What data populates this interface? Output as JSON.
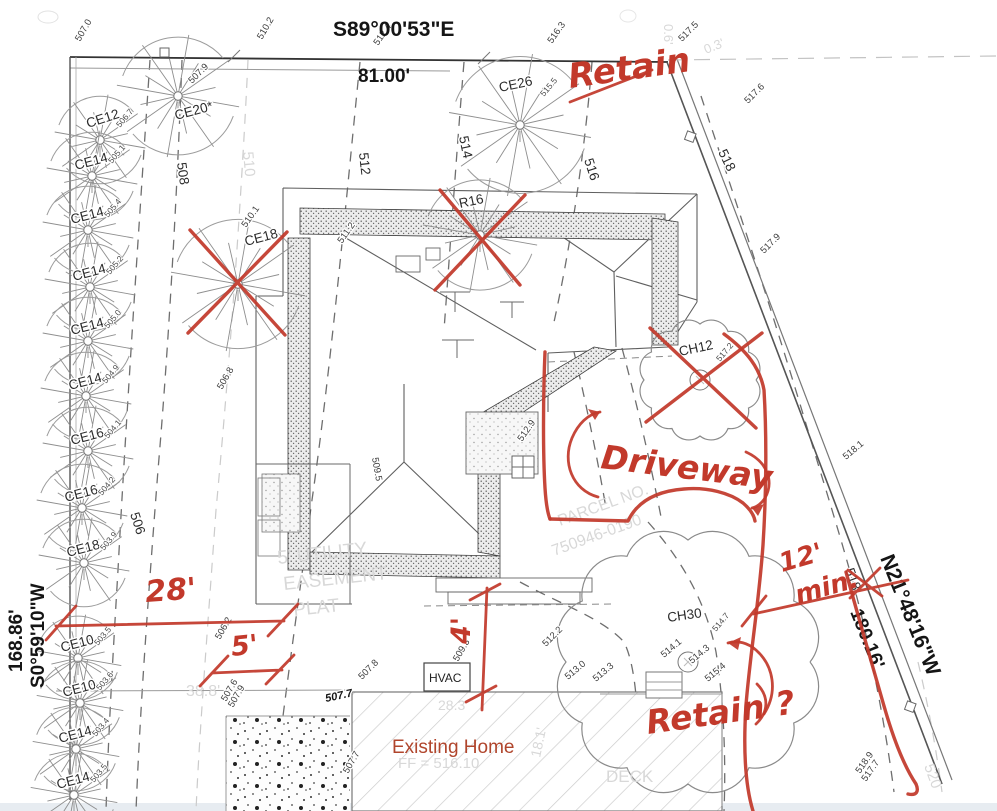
{
  "boundary": {
    "top_bearing": "S89°00'53\"E",
    "top_distance": "81.00'",
    "left_distance": "168.86'",
    "left_bearing": "S0°59'10\"W",
    "right_bearing": "N21°48'16\"W",
    "right_distance": "180.16'"
  },
  "structures": {
    "hvac": "HVAC",
    "existing_home": "Existing Home"
  },
  "red_annotations": {
    "retain_top": "Retain",
    "driveway": "Driveway",
    "dim28": "28'",
    "dim5": "5'",
    "dim4": "4'",
    "dim12": "12'",
    "dim12b": "min.",
    "retain_q": "Retain ?"
  },
  "contour_labels": [
    {
      "t": "506",
      "x": 130,
      "y": 514,
      "r": 72
    },
    {
      "t": "508",
      "x": 177,
      "y": 163,
      "r": 82
    },
    {
      "t": "512",
      "x": 359,
      "y": 153,
      "r": 84
    },
    {
      "t": "514",
      "x": 459,
      "y": 137,
      "r": 78
    },
    {
      "t": "516",
      "x": 584,
      "y": 160,
      "r": 72
    },
    {
      "t": "518",
      "x": 718,
      "y": 152,
      "r": 64
    },
    {
      "t": "518",
      "x": 845,
      "y": 570,
      "r": 70
    }
  ],
  "spots": [
    {
      "t": "507.0",
      "x": 80,
      "y": 42,
      "r": -60
    },
    {
      "t": "510.2",
      "x": 262,
      "y": 40,
      "r": -60
    },
    {
      "t": "512.4",
      "x": 378,
      "y": 46,
      "r": -55
    },
    {
      "t": "516.3",
      "x": 552,
      "y": 44,
      "r": -55
    },
    {
      "t": "517.5",
      "x": 682,
      "y": 42,
      "r": -45
    },
    {
      "t": "517.6",
      "x": 748,
      "y": 104,
      "r": -45
    },
    {
      "t": "517.9",
      "x": 764,
      "y": 254,
      "r": -45
    },
    {
      "t": "507.9",
      "x": 192,
      "y": 84,
      "r": -45
    },
    {
      "t": "510.1",
      "x": 246,
      "y": 228,
      "r": -55
    },
    {
      "t": "511.2",
      "x": 342,
      "y": 244,
      "r": -55
    },
    {
      "t": "509.5",
      "x": 372,
      "y": 458,
      "r": 80
    },
    {
      "t": "512.9",
      "x": 522,
      "y": 442,
      "r": -55
    },
    {
      "t": "506.8",
      "x": 222,
      "y": 390,
      "r": -60
    },
    {
      "t": "518.1",
      "x": 846,
      "y": 460,
      "r": -40
    },
    {
      "t": "514.1",
      "x": 664,
      "y": 658,
      "r": -40
    },
    {
      "t": "514.3",
      "x": 692,
      "y": 664,
      "r": -40
    },
    {
      "t": "515.4",
      "x": 708,
      "y": 682,
      "r": -40
    },
    {
      "t": "513.0",
      "x": 568,
      "y": 680,
      "r": -40
    },
    {
      "t": "513.3",
      "x": 596,
      "y": 682,
      "r": -40
    },
    {
      "t": "512.2",
      "x": 546,
      "y": 647,
      "r": -45
    },
    {
      "t": "509.3",
      "x": 458,
      "y": 662,
      "r": -60
    },
    {
      "t": "507.8",
      "x": 362,
      "y": 680,
      "r": -45
    },
    {
      "t": "507.7",
      "x": 326,
      "y": 702,
      "r": -12,
      "b": true
    },
    {
      "t": "507.6",
      "x": 226,
      "y": 702,
      "r": -60
    },
    {
      "t": "507.9",
      "x": 233,
      "y": 708,
      "r": -60
    },
    {
      "t": "506.2",
      "x": 220,
      "y": 640,
      "r": -60
    },
    {
      "t": "507.7",
      "x": 348,
      "y": 774,
      "r": -60
    },
    {
      "t": "518.9",
      "x": 860,
      "y": 774,
      "r": -55
    },
    {
      "t": "517.7",
      "x": 866,
      "y": 782,
      "r": -55
    }
  ],
  "faded_labels": [
    {
      "t": "0.6'",
      "x": 664,
      "y": 24,
      "r": 90,
      "s": 13
    },
    {
      "t": "0.3'",
      "x": 706,
      "y": 54,
      "r": -22,
      "s": 13
    },
    {
      "t": "510",
      "x": 243,
      "y": 152,
      "r": 85,
      "s": 15
    },
    {
      "t": "38.8'",
      "x": 186,
      "y": 696,
      "s": 16
    },
    {
      "t": "28.3'",
      "x": 438,
      "y": 710,
      "s": 14
    },
    {
      "t": "18.1'",
      "x": 540,
      "y": 758,
      "r": -78,
      "s": 14
    },
    {
      "t": "5' UTILITY",
      "x": 278,
      "y": 564,
      "r": -6,
      "s": 19
    },
    {
      "t": "EASEMENT",
      "x": 284,
      "y": 590,
      "r": -6,
      "s": 19
    },
    {
      "t": "PLAT",
      "x": 294,
      "y": 616,
      "r": -6,
      "s": 19
    },
    {
      "t": "PARCEL NO.",
      "x": 560,
      "y": 526,
      "r": -20,
      "s": 16
    },
    {
      "t": "750946-0190",
      "x": 554,
      "y": 556,
      "r": -20,
      "s": 16
    },
    {
      "t": "DECK",
      "x": 606,
      "y": 782,
      "s": 17
    },
    {
      "t": "520",
      "x": 924,
      "y": 766,
      "r": 70,
      "s": 15
    },
    {
      "t": "FF = 516.10",
      "x": 398,
      "y": 768,
      "s": 15
    }
  ],
  "trees": [
    {
      "label": "CE12",
      "x": 100,
      "y": 140,
      "rad": 46,
      "lx": 88,
      "ly": 128,
      "lr": -18,
      "elev": "506.7"
    },
    {
      "label": "CE20*",
      "x": 178,
      "y": 96,
      "rad": 62,
      "lx": 176,
      "ly": 120,
      "lr": -15,
      "elev": ""
    },
    {
      "label": "CE14",
      "x": 92,
      "y": 176,
      "rad": 46,
      "lx": 76,
      "ly": 170,
      "lr": -15,
      "elev": "505.1"
    },
    {
      "label": "CE14",
      "x": 88,
      "y": 230,
      "rad": 46,
      "lx": 72,
      "ly": 224,
      "lr": -15,
      "elev": "505.4"
    },
    {
      "label": "CE14",
      "x": 90,
      "y": 287,
      "rad": 46,
      "lx": 74,
      "ly": 281,
      "lr": -15,
      "elev": "505.2"
    },
    {
      "label": "CE14",
      "x": 88,
      "y": 341,
      "rad": 46,
      "lx": 72,
      "ly": 335,
      "lr": -15,
      "elev": "505.0"
    },
    {
      "label": "CE14",
      "x": 86,
      "y": 396,
      "rad": 46,
      "lx": 70,
      "ly": 390,
      "lr": -15,
      "elev": "504.9"
    },
    {
      "label": "CE16",
      "x": 88,
      "y": 451,
      "rad": 46,
      "lx": 72,
      "ly": 445,
      "lr": -15,
      "elev": "504.1"
    },
    {
      "label": "CE16",
      "x": 82,
      "y": 508,
      "rad": 46,
      "lx": 66,
      "ly": 502,
      "lr": -15,
      "elev": "504.2"
    },
    {
      "label": "CE18",
      "x": 84,
      "y": 563,
      "rad": 46,
      "lx": 68,
      "ly": 557,
      "lr": -15,
      "elev": "503.9"
    },
    {
      "label": "CE10",
      "x": 78,
      "y": 658,
      "rad": 44,
      "lx": 62,
      "ly": 652,
      "lr": -15,
      "elev": "503.5"
    },
    {
      "label": "CE10",
      "x": 80,
      "y": 703,
      "rad": 44,
      "lx": 64,
      "ly": 697,
      "lr": -15,
      "elev": "503.6"
    },
    {
      "label": "CE14",
      "x": 76,
      "y": 749,
      "rad": 44,
      "lx": 60,
      "ly": 743,
      "lr": -15,
      "elev": "503.4"
    },
    {
      "label": "CE14",
      "x": 74,
      "y": 795,
      "rad": 44,
      "lx": 58,
      "ly": 789,
      "lr": -15,
      "elev": "503.5"
    },
    {
      "label": "CE18",
      "x": 238,
      "y": 284,
      "rad": 68,
      "lx": 246,
      "ly": 246,
      "lr": -15,
      "elev": ""
    },
    {
      "label": "CE26",
      "x": 520,
      "y": 125,
      "rad": 72,
      "lx": 500,
      "ly": 92,
      "lr": -12,
      "elev": "515.5",
      "ex": 24,
      "ey": -28
    },
    {
      "label": "R16",
      "x": 480,
      "y": 235,
      "rad": 58,
      "lx": 460,
      "ly": 208,
      "lr": -12,
      "elev": ""
    },
    {
      "label": "CH12",
      "x": 700,
      "y": 380,
      "rad": 56,
      "type": "ch",
      "lx": 680,
      "ly": 356,
      "lr": -12,
      "elev": "517.2",
      "ex": 20,
      "ey": -18
    },
    {
      "label": "CH30",
      "x": 688,
      "y": 662,
      "rad": 122,
      "type": "ch",
      "lx": 668,
      "ly": 622,
      "lr": -8,
      "elev": "514.7",
      "ex": 28,
      "ey": -30
    }
  ]
}
